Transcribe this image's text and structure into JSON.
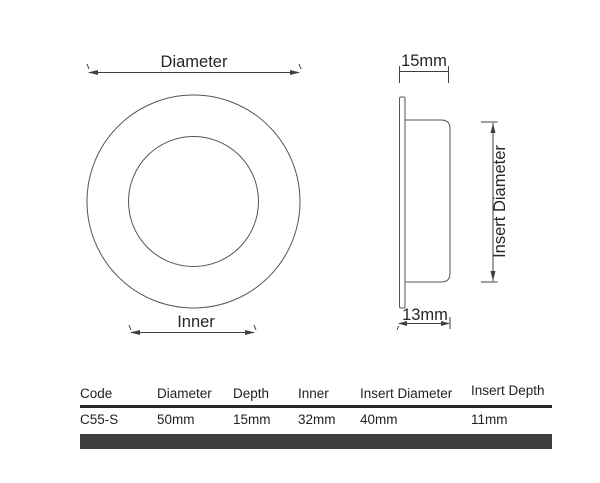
{
  "drawing": {
    "front": {
      "diameter_label": "Diameter",
      "inner_label": "Inner"
    },
    "side": {
      "depth_label": "15mm",
      "body_depth_label": "13mm",
      "insert_diameter_label": "Insert Diameter"
    }
  },
  "spec_table": {
    "headers": [
      "Code",
      "Diameter",
      "Depth",
      "Inner",
      "Insert Diameter",
      "Insert Depth"
    ],
    "row": [
      "C55-S",
      "50mm",
      "15mm",
      "32mm",
      "40mm",
      "11mm"
    ]
  },
  "colors": {
    "outline_line": "#565656",
    "dimension_line": "#3f3f3f",
    "text": "#262626",
    "table_rule": "#262626",
    "table_bar": "#3d3d3d"
  }
}
